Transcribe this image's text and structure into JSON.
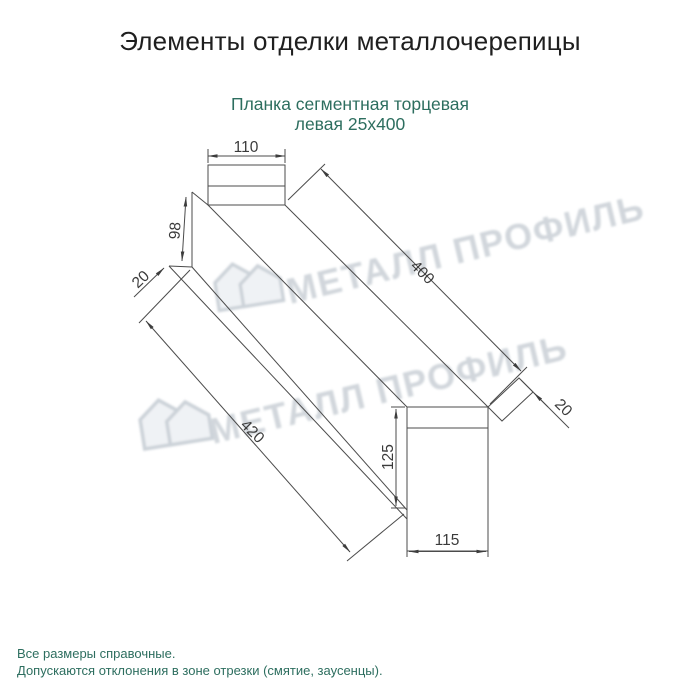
{
  "title": "Элементы отделки металлочерепицы",
  "subtitle": {
    "line1": "Планка сегментная торцевая",
    "line2": "левая 25х400"
  },
  "dims": {
    "d110": "110",
    "d98": "98",
    "d20_left": "20",
    "d400": "400",
    "d420": "420",
    "d20_right": "20",
    "d125": "125",
    "d115": "115"
  },
  "watermark": {
    "text": "МЕТАЛЛ ПРОФИЛЬ",
    "logo": "house-icon"
  },
  "footer": {
    "line1": "Все размеры справочные.",
    "line2": "Допускаются отклонения в зоне отрезки (смятие, заусенцы)."
  },
  "colors": {
    "title_text": "#1f1f1f",
    "accent_text": "#2d6e5f",
    "line": "#4b4b4b",
    "dim_text": "#3b3b3b",
    "watermark": "#ccd2d8",
    "background": "#ffffff"
  }
}
